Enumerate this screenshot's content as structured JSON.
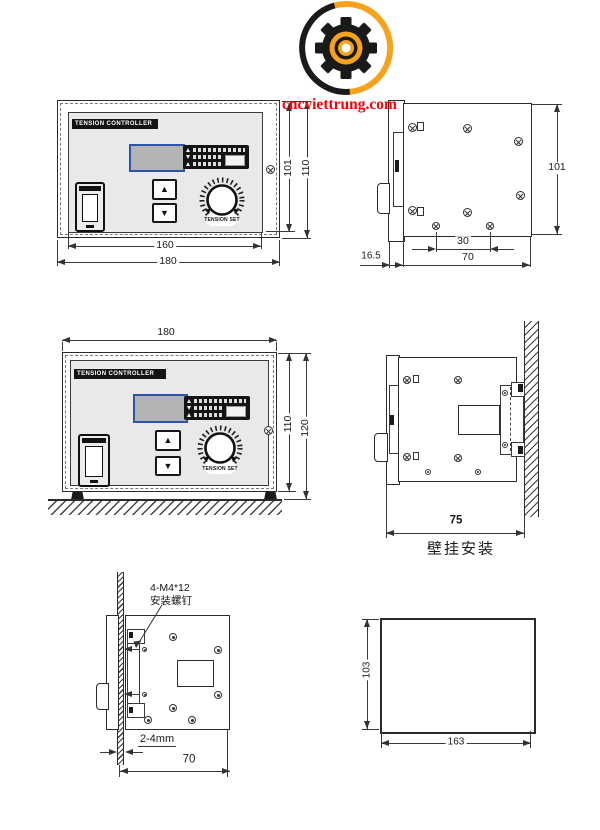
{
  "watermark": {
    "text": "cncviettrung.com",
    "color": "#ff0000"
  },
  "logo": {
    "name": "gear-logo",
    "orange": "#f6a21d",
    "black": "#1a1a1a"
  },
  "device": {
    "title": "TENSION CONTROLLER",
    "knob_label": "TENSION SET"
  },
  "views": {
    "front_top": {
      "inner_width": "160",
      "outer_width": "180",
      "panel_height": "101",
      "outer_height": "110"
    },
    "side_top": {
      "height": "101",
      "hole_spacing": "30",
      "depth": "70",
      "bezel_depth": "16.5"
    },
    "front_table": {
      "width": "180",
      "height": "110",
      "total_height": "120"
    },
    "wall": {
      "depth": "75",
      "caption": "壁挂安装"
    },
    "panel_mount": {
      "screw_note_1": "4-M4*12",
      "screw_note_2": "安装螺钉",
      "panel_thickness": "2-4mm",
      "depth": "70"
    },
    "cutout": {
      "height": "103",
      "width": "163"
    }
  }
}
